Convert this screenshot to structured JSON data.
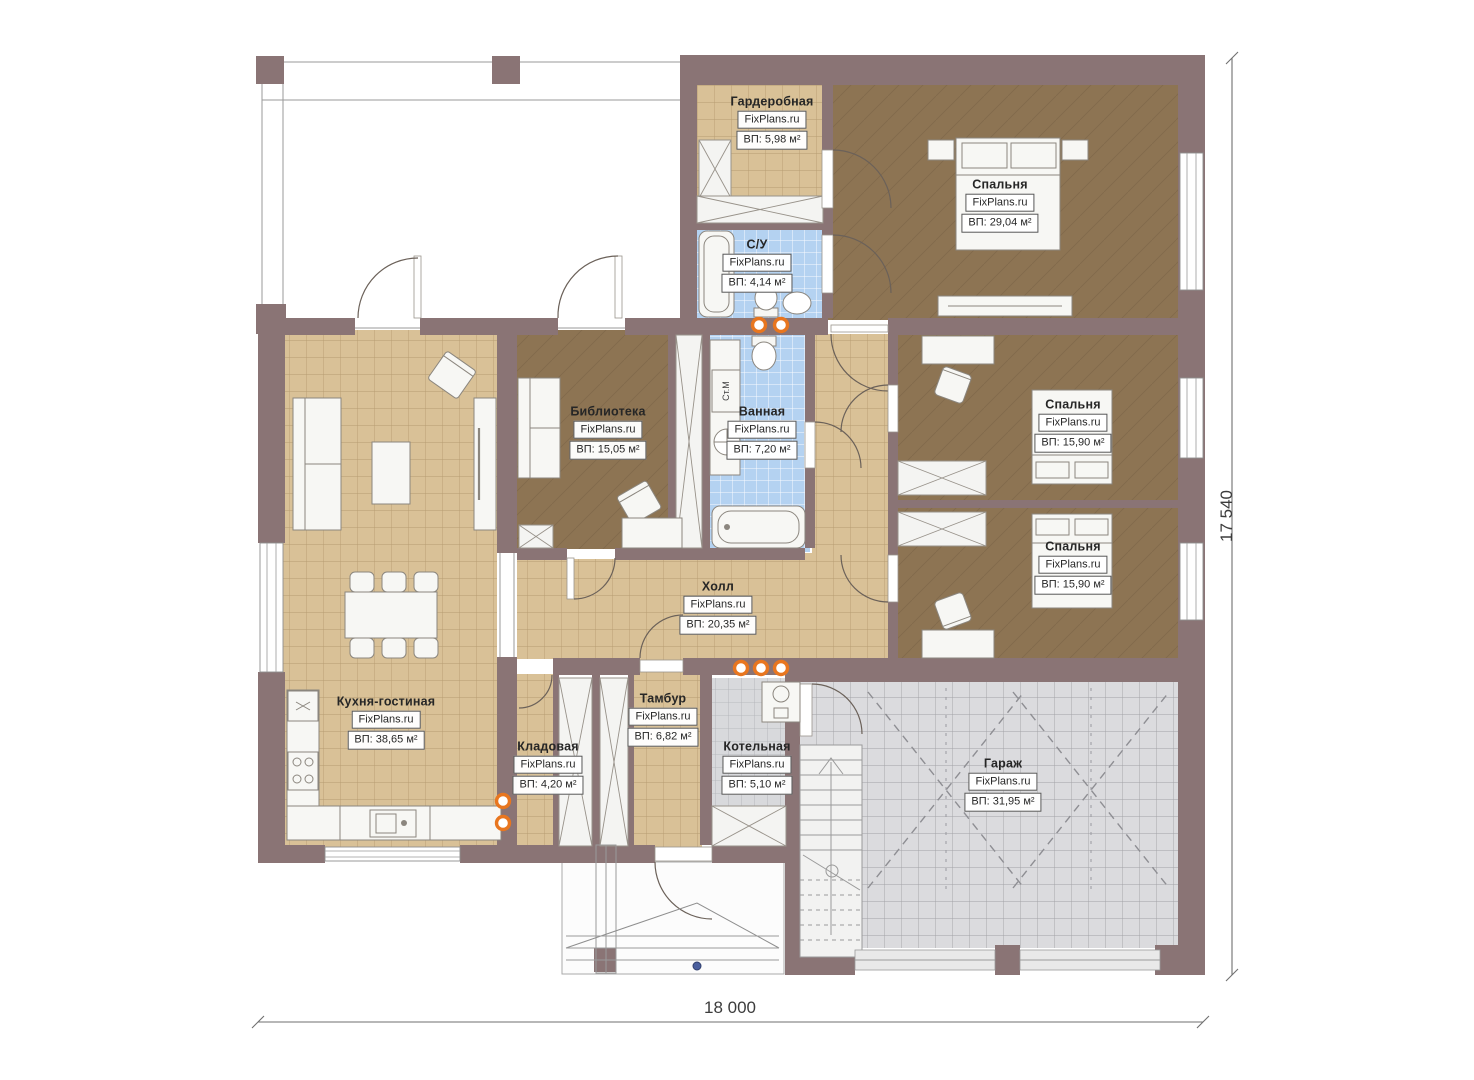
{
  "plan": {
    "washing_machine_label": "Ст.М"
  },
  "rooms": [
    {
      "id": "wardrobe",
      "name": "Гардеробная",
      "watermark": "FixPlans.ru",
      "area": "ВП: 5,98 м²"
    },
    {
      "id": "wc",
      "name": "С/У",
      "watermark": "FixPlans.ru",
      "area": "ВП: 4,14 м²"
    },
    {
      "id": "bedroom-1",
      "name": "Спальня",
      "watermark": "FixPlans.ru",
      "area": "ВП: 29,04 м²"
    },
    {
      "id": "library",
      "name": "Библиотека",
      "watermark": "FixPlans.ru",
      "area": "ВП: 15,05 м²"
    },
    {
      "id": "bathroom",
      "name": "Ванная",
      "watermark": "FixPlans.ru",
      "area": "ВП: 7,20 м²"
    },
    {
      "id": "bedroom-2",
      "name": "Спальня",
      "watermark": "FixPlans.ru",
      "area": "ВП: 15,90 м²"
    },
    {
      "id": "bedroom-3",
      "name": "Спальня",
      "watermark": "FixPlans.ru",
      "area": "ВП: 15,90 м²"
    },
    {
      "id": "hall",
      "name": "Холл",
      "watermark": "FixPlans.ru",
      "area": "ВП: 20,35 м²"
    },
    {
      "id": "kitchen-living",
      "name": "Кухня-гостиная",
      "watermark": "FixPlans.ru",
      "area": "ВП: 38,65 м²"
    },
    {
      "id": "storage",
      "name": "Кладовая",
      "watermark": "FixPlans.ru",
      "area": "ВП: 4,20 м²"
    },
    {
      "id": "vestibule",
      "name": "Тамбур",
      "watermark": "FixPlans.ru",
      "area": "ВП: 6,82 м²"
    },
    {
      "id": "boiler-room",
      "name": "Котельная",
      "watermark": "FixPlans.ru",
      "area": "ВП: 5,10 м²"
    },
    {
      "id": "garage",
      "name": "Гараж",
      "watermark": "FixPlans.ru",
      "area": "ВП: 31,95 м²"
    }
  ],
  "dimensions": {
    "width": "18 000",
    "height": "17 540"
  },
  "colors": {
    "wall": "#8a7475",
    "floor_tan": "#d9c197",
    "floor_brown": "#8d7453",
    "tile_blue": "#b4d2f1",
    "garage_gray": "#dbdbde",
    "radiator_orange": "#e8761f"
  }
}
